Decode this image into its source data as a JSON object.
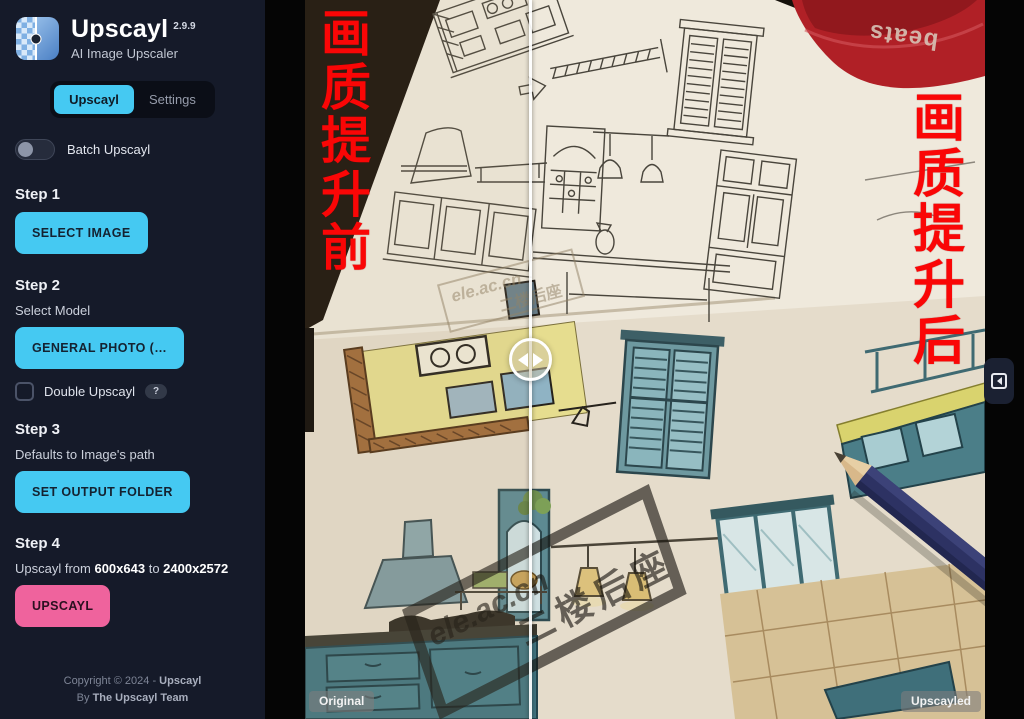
{
  "app": {
    "name": "Upscayl",
    "version": "2.9.9",
    "tagline": "AI Image Upscaler"
  },
  "nav": {
    "tab_upscayl": "Upscayl",
    "tab_settings": "Settings"
  },
  "batch": {
    "label": "Batch Upscayl",
    "on": false
  },
  "step1": {
    "title": "Step 1",
    "select_image_button": "SELECT IMAGE"
  },
  "step2": {
    "title": "Step 2",
    "caption": "Select Model",
    "model_button": "GENERAL PHOTO (…",
    "double_upscayl_label": "Double Upscayl",
    "help_badge": "?",
    "double_checked": false
  },
  "step3": {
    "title": "Step 3",
    "caption": "Defaults to Image's path",
    "output_button": "SET OUTPUT FOLDER"
  },
  "step4": {
    "title": "Step 4",
    "caption_prefix": "Upscayl from ",
    "from_size": "600x643",
    "to_word": " to ",
    "to_size": "2400x2572",
    "upscayl_button": "UPSCAYL"
  },
  "footer": {
    "copyright_prefix": "Copyright © 2024 - ",
    "brand": "Upscayl",
    "by_prefix": "By ",
    "team": "The Upscayl Team"
  },
  "viewer": {
    "before_overlay": "画质提升前",
    "after_overlay": "画质提升后",
    "original_label": "Original",
    "upscayled_label": "Upscayled",
    "watermark_small_line1": "ele.ac.cn",
    "watermark_small_line2": "二楼后座",
    "watermark_big_line1": "ele.ac.cn",
    "watermark_big_line2": "二楼后座",
    "case_brand": "beats"
  },
  "colors": {
    "accent_cyan": "#45c9f2",
    "action_pink": "#ef639d",
    "overlay_red": "#fa0606",
    "sidebar_bg": "#151a29"
  }
}
